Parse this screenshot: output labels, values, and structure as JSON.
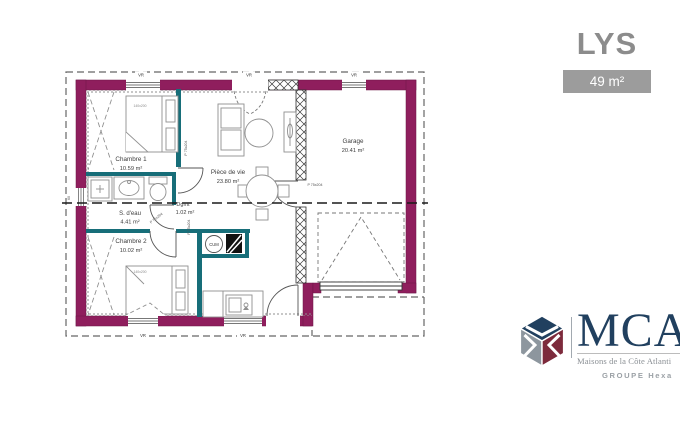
{
  "header": {
    "model": "LYS",
    "area": "49 m²"
  },
  "plan": {
    "rooms": {
      "chambre1": {
        "name": "Chambre 1",
        "area": "10.59 m²"
      },
      "sdeau": {
        "name": "S. d'eau",
        "area": "4.41 m²"
      },
      "dgmt": {
        "name": "Dgmt",
        "area": "1.02 m²"
      },
      "chambre2": {
        "name": "Chambre 2",
        "area": "10.02 m²"
      },
      "piece_de_vie": {
        "name": "Pièce de vie",
        "area": "23.80 m²"
      },
      "garage": {
        "name": "Garage",
        "area": "20.41 m²"
      }
    },
    "annotations": {
      "bed_size": "140x200",
      "door_size": "P 75x204",
      "roller_shutter": "VR",
      "water_heater": "CUM",
      "left_window": "60"
    },
    "colors": {
      "exterior_wall": "#8f1e5d",
      "interior_wall": "#176e79"
    }
  },
  "brand": {
    "initials": "MCA",
    "tagline": "Maisons de la Côte Atlanti",
    "group": "GROUPE Hexa",
    "navy": "#21405f",
    "maroon": "#7d2a3c",
    "gray": "#8d969e"
  }
}
